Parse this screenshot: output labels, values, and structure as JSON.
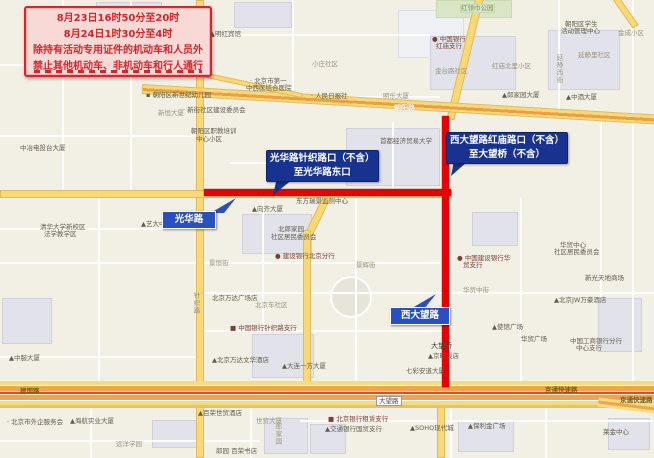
{
  "notice": {
    "line1": "8月23日16时50分至20时",
    "line2": "8月24日1时30分至4时",
    "line3": "除持有活动专用证件的机动车和人员外",
    "line4": "禁止其他机动车、非机动车和行人通行"
  },
  "callouts": {
    "guanghua": {
      "line1": "光华路针织路口（不含）",
      "line2": "至光华路东口"
    },
    "xidawang": {
      "line1": "西大望路红庙路口（不含）",
      "line2": "至大望桥（不含）"
    }
  },
  "road_tags": {
    "guanghua": "光华路",
    "xidawang": "西大望路"
  },
  "signs": {
    "dawanglu": "大望路"
  },
  "colors": {
    "restricted_route": "#e60104",
    "major_road": "#f9d878",
    "expressway": "#f0a44e",
    "callout_blue": "#17338f",
    "tag_blue": "#2a50bf",
    "notice_red": "#d5262c",
    "notice_bg": "#f8d9d6"
  },
  "map_labels": [
    {
      "t": "▪ 朝阳区新世纪幼儿园",
      "x": 146,
      "y": 92,
      "c": "poi"
    },
    {
      "t": "新恒大厦",
      "x": 158,
      "y": 110,
      "c": "street"
    },
    {
      "t": "· 新街社区建设委员会",
      "x": 183,
      "y": 107,
      "c": "poi"
    },
    {
      "t": "朝阳区职教培训",
      "x": 191,
      "y": 128,
      "c": "poi"
    },
    {
      "t": "中心小区",
      "x": 196,
      "y": 136,
      "c": "poi"
    },
    {
      "t": "▲明红宾馆",
      "x": 210,
      "y": 31,
      "c": "poi"
    },
    {
      "t": "小庄社区",
      "x": 312,
      "y": 61,
      "c": "street"
    },
    {
      "t": "· 北京市第一",
      "x": 250,
      "y": 78,
      "c": "poi"
    },
    {
      "t": "中西医结合医院",
      "x": 246,
      "y": 85,
      "c": "poi"
    },
    {
      "t": "中冶电投台大厦",
      "x": 20,
      "y": 145,
      "c": "poi"
    },
    {
      "t": "清华大学新校区",
      "x": 40,
      "y": 224,
      "c": "poi"
    },
    {
      "t": "法学教学区",
      "x": 44,
      "y": 231,
      "c": "poi"
    },
    {
      "t": "▲艺大中心",
      "x": 141,
      "y": 221,
      "c": "poi"
    },
    {
      "t": "· 人民日报社",
      "x": 311,
      "y": 93,
      "c": "poi"
    },
    {
      "t": "明乐大厦",
      "x": 383,
      "y": 93,
      "c": "street"
    },
    {
      "t": "首都经济贸易大学",
      "x": 380,
      "y": 138,
      "c": "poi"
    },
    {
      "t": "▲中酒大厦",
      "x": 566,
      "y": 94,
      "c": "poi"
    },
    {
      "t": "东方瑞景监测中心",
      "x": 296,
      "y": 198,
      "c": "poi"
    },
    {
      "t": "▲向齐大厦",
      "x": 252,
      "y": 206,
      "c": "poi"
    },
    {
      "t": "北郎家园",
      "x": 278,
      "y": 226,
      "c": "poi"
    },
    {
      "t": "社区居民委员会",
      "x": 271,
      "y": 234,
      "c": "poi"
    },
    {
      "t": "● 建设银行北京分行",
      "x": 275,
      "y": 253,
      "c": "bank"
    },
    {
      "t": "景恒街",
      "x": 209,
      "y": 260,
      "c": "street"
    },
    {
      "t": "景辉街",
      "x": 356,
      "y": 262,
      "c": "street"
    },
    {
      "t": "华贸中心",
      "x": 560,
      "y": 242,
      "c": "poi"
    },
    {
      "t": "社区居民委员会",
      "x": 554,
      "y": 249,
      "c": "poi"
    },
    {
      "t": "● 中国建设银行华",
      "x": 457,
      "y": 255,
      "c": "bank"
    },
    {
      "t": "贸支行",
      "x": 463,
      "y": 262,
      "c": "bank"
    },
    {
      "t": "新光天地商场",
      "x": 585,
      "y": 275,
      "c": "poi"
    },
    {
      "t": "华贸中街",
      "x": 463,
      "y": 287,
      "c": "street"
    },
    {
      "t": "▲北京JW万豪酒店",
      "x": 554,
      "y": 297,
      "c": "poi"
    },
    {
      "t": "▲使馆广场",
      "x": 492,
      "y": 324,
      "c": "poi"
    },
    {
      "t": "华贸广场",
      "x": 521,
      "y": 336,
      "c": "poi"
    },
    {
      "t": "中国工商银行分行",
      "x": 570,
      "y": 338,
      "c": "poi"
    },
    {
      "t": "中心支行",
      "x": 576,
      "y": 345,
      "c": "poi"
    },
    {
      "t": "▲中服大厦",
      "x": 9,
      "y": 355,
      "c": "poi"
    },
    {
      "t": "北京万达广场店",
      "x": 212,
      "y": 295,
      "c": "poi"
    },
    {
      "t": "北京车社区",
      "x": 255,
      "y": 302,
      "c": "street"
    },
    {
      "t": "■ 中国银行针织路支行",
      "x": 230,
      "y": 325,
      "c": "bank"
    },
    {
      "t": "▲北京万达文华酒店",
      "x": 212,
      "y": 357,
      "c": "poi"
    },
    {
      "t": "▲大连一方大厦",
      "x": 282,
      "y": 363,
      "c": "poi"
    },
    {
      "t": "▲京旺饭店",
      "x": 428,
      "y": 353,
      "c": "poi"
    },
    {
      "t": "七彩安道大厦",
      "x": 406,
      "y": 368,
      "c": "poi"
    },
    {
      "t": "大望桥",
      "x": 431,
      "y": 343,
      "c": "bridge"
    },
    {
      "t": "▲郎家园大厦",
      "x": 502,
      "y": 92,
      "c": "poi"
    },
    {
      "t": "金台路社区",
      "x": 435,
      "y": 68,
      "c": "street"
    },
    {
      "t": "● 中国银行",
      "x": 432,
      "y": 36,
      "c": "bank"
    },
    {
      "t": "红庙支行",
      "x": 436,
      "y": 43,
      "c": "bank"
    },
    {
      "t": "红庙北里小区",
      "x": 492,
      "y": 63,
      "c": "street"
    },
    {
      "t": "朝阳区学生",
      "x": 565,
      "y": 21,
      "c": "poi"
    },
    {
      "t": "活动管理中心",
      "x": 561,
      "y": 28,
      "c": "poi"
    },
    {
      "t": "延静里社区",
      "x": 578,
      "y": 52,
      "c": "street"
    },
    {
      "t": "金成小区",
      "x": 618,
      "y": 30,
      "c": "street"
    },
    {
      "t": "红领巾公园",
      "x": 460,
      "y": 4,
      "c": "park"
    },
    {
      "t": "针织路",
      "x": 192,
      "y": 292,
      "c": "street",
      "v": 1
    },
    {
      "t": "延静西街",
      "x": 555,
      "y": 54,
      "c": "street",
      "v": 1
    },
    {
      "t": "郎家园",
      "x": 274,
      "y": 423,
      "c": "street",
      "v": 1
    },
    {
      "t": "朝阳路",
      "x": 394,
      "y": 105,
      "c": "white"
    },
    {
      "t": "建国路",
      "x": 20,
      "y": 388,
      "c": "onroad"
    },
    {
      "t": "京通快速路",
      "x": 545,
      "y": 387,
      "c": "onroad"
    },
    {
      "t": "京通快速路",
      "x": 620,
      "y": 397,
      "c": "onroad"
    },
    {
      "t": "· 北京市外企服务会",
      "x": 7,
      "y": 419,
      "c": "poi"
    },
    {
      "t": "▲海航实业大厦",
      "x": 70,
      "y": 418,
      "c": "poi"
    },
    {
      "t": "远洋学园",
      "x": 116,
      "y": 441,
      "c": "street"
    },
    {
      "t": "▲百荣世贸酒店",
      "x": 198,
      "y": 410,
      "c": "poi"
    },
    {
      "t": "世贸大厦",
      "x": 256,
      "y": 418,
      "c": "street"
    },
    {
      "t": "郎园 百荣书店",
      "x": 216,
      "y": 448,
      "c": "poi"
    },
    {
      "t": "■ 北京银行租赁支行",
      "x": 328,
      "y": 416,
      "c": "bank"
    },
    {
      "t": "▲交通银行国贸支行",
      "x": 325,
      "y": 426,
      "c": "poi"
    },
    {
      "t": "▲SOHO现代城",
      "x": 410,
      "y": 425,
      "c": "poi"
    },
    {
      "t": "▲保利金广场",
      "x": 468,
      "y": 423,
      "c": "poi"
    },
    {
      "t": "莱金中心",
      "x": 603,
      "y": 429,
      "c": "poi"
    }
  ]
}
